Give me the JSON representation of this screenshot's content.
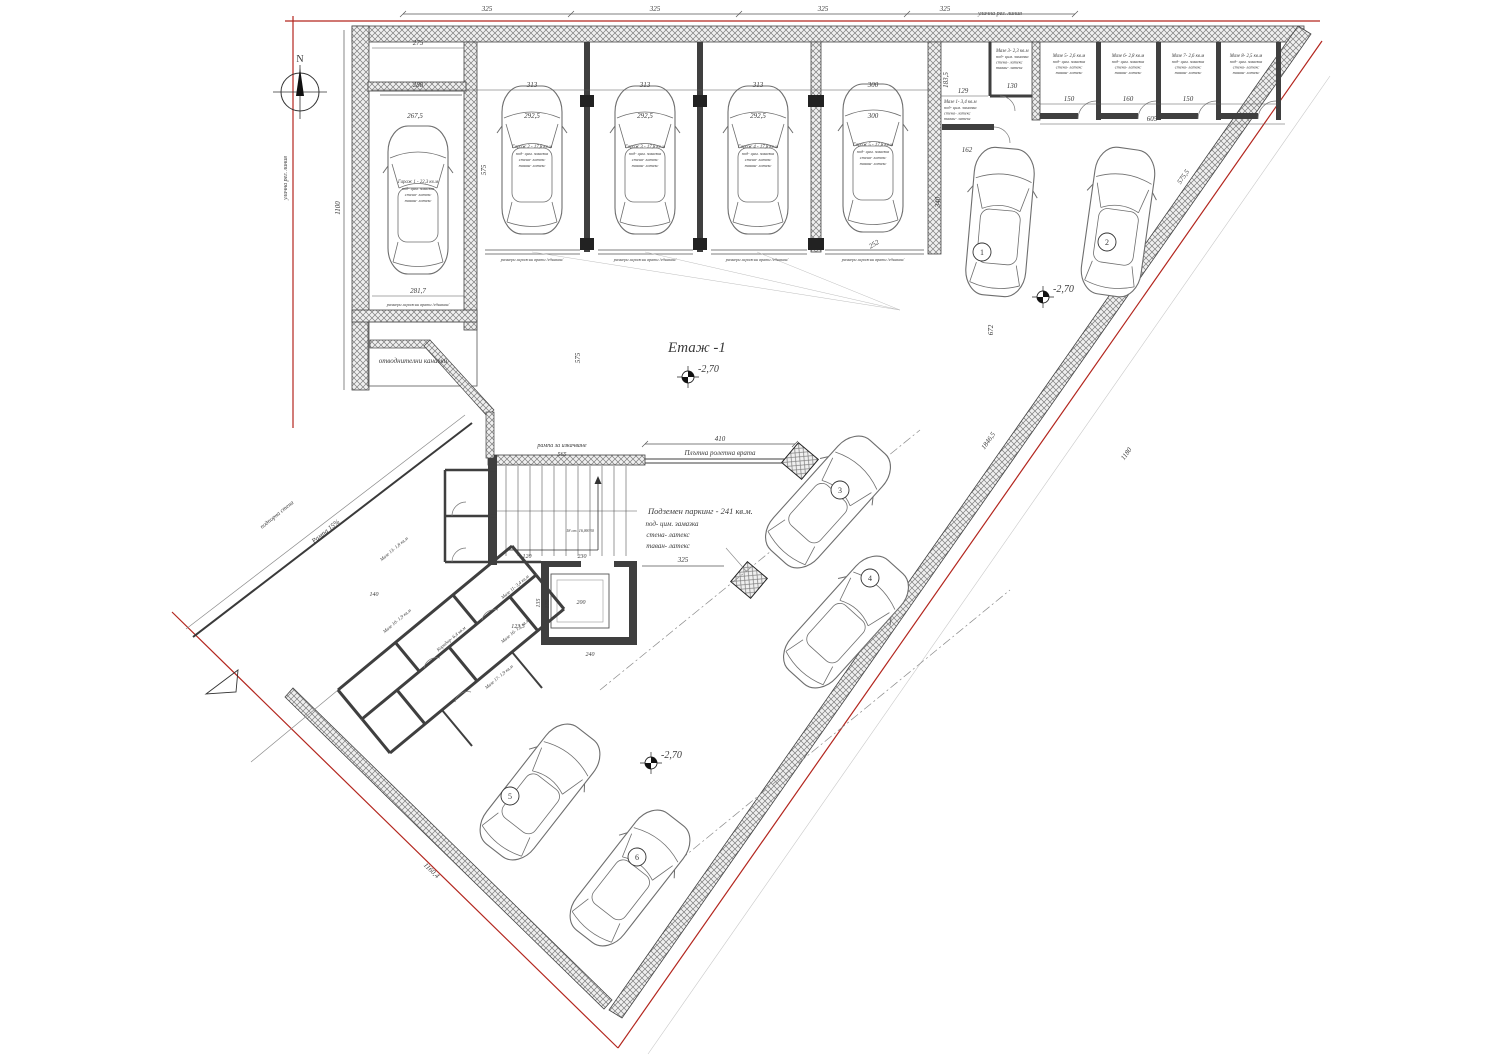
{
  "drawing": {
    "title": "Етаж -1",
    "north": "N"
  },
  "levels": {
    "val": "-2,70"
  },
  "streets": {
    "reg_line_top": "улична рег. линия",
    "reg_line_left": "улична рег. линия"
  },
  "notes": {
    "drainage": "отводнителни канавки",
    "ramp": "Рампа 15%",
    "retaining_wall": "подпорна стена",
    "ramp_up": "рампа за изкачване",
    "roller_door": "Плътна ролетна врата",
    "garage_door_note": "размери гаражни врати /еднакви/",
    "stairs": "18 ст. 16,88/30",
    "parking_title": "Подземен паркинг - 241 кв.м.",
    "finish_floor": "под- цим. замазка",
    "finish_walls": "стена- латекс",
    "finish_ceiling": "таван- латекс"
  },
  "rooms": {
    "garage1": "Гараж 1 - 22,3 кв.м",
    "garage2": "Гараж 2 - 17,8 кв.м",
    "garage3": "Гараж 3 - 17,8 кв.м",
    "garage4": "Гараж 4 - 17,8 кв.м",
    "garage5": "Гараж 5 - 17,8 кв.м",
    "maze1": "Мазе 1- 3,4 кв.м",
    "maze3": "Мазе 3- 2,3 кв.м",
    "maze5": "Мазе 5- 2,6 кв.м",
    "maze6": "Мазе 6- 2,8 кв.м",
    "maze7": "Мазе 7- 2,6 кв.м",
    "maze8": "Мазе 8- 2,5 кв.м",
    "maze10": "Мазе 10- 1,9 кв.м",
    "maze11": "Мазе 11- 3,4 кв.м",
    "maze13": "Мазе 13- 1,8 кв.м",
    "maze16": "Мазе 16- 1,7 кв.м",
    "maze17": "Мазе 17- 1,9 кв.м",
    "corridor": "Коридор- 6,4 кв.м"
  },
  "spots": {
    "s1": "1",
    "s2": "2",
    "s3": "3",
    "s4": "4",
    "s5": "5",
    "s6": "6"
  },
  "dims": {
    "d325": "325",
    "d275": "275",
    "d288": "288",
    "d313": "313",
    "d300": "300",
    "d2925": "292,5",
    "d2675": "267,5",
    "d2817": "281,7",
    "d1100": "1100",
    "d575": "575",
    "d129": "129",
    "d130": "130",
    "d150": "150",
    "d160": "160",
    "d1835": "183,5",
    "d605": "605",
    "d162": "162",
    "d340": "340",
    "d672": "672",
    "d252": "252",
    "d5755": "575,5",
    "d18465": "1846,5",
    "d1180": "1180",
    "d410": "410",
    "d565": "565",
    "d120": "120",
    "d230": "230",
    "d200": "200",
    "d170": "170",
    "d240": "240",
    "d11604": "1160,4",
    "d1233": "123,3",
    "d140": "140",
    "d135": "135"
  },
  "colors": {
    "regulation_line": "#b3261e",
    "wall_fill": "#efefef",
    "hatch_line": "#7d7d7d",
    "line": "#3a3a3a"
  }
}
